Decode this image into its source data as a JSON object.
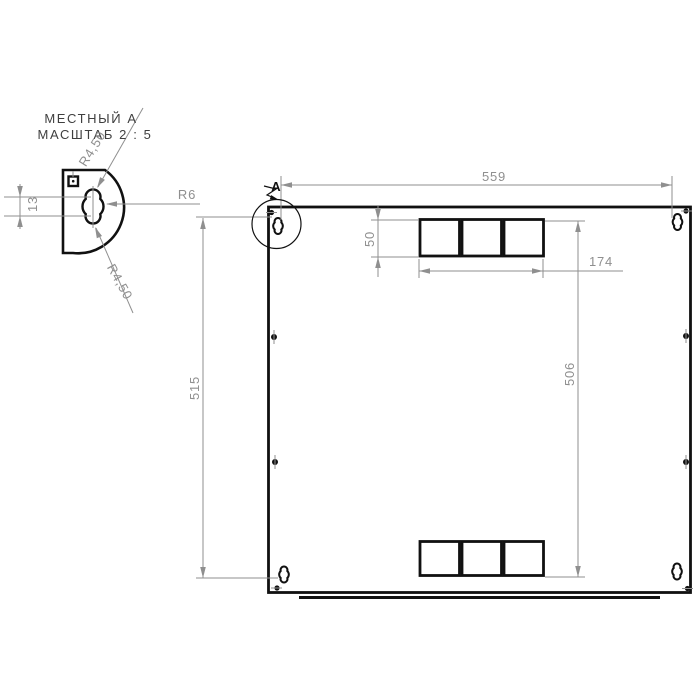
{
  "colors": {
    "outline": "#111111",
    "dimension": "#8f8f8f",
    "background": "#ffffff",
    "title": "#3f3f3f"
  },
  "detail_view": {
    "title": "МЕСТНЫЙ А",
    "scale_note": "МАСШТАБ 2 : 5",
    "dim_lobe_spacing": "13",
    "radius_top_lobe": "R4,50",
    "radius_bottom_lobe": "R4,50",
    "radius_middle": "R6"
  },
  "main_view": {
    "detail_marker": "A",
    "dim_overall_width": "559",
    "dim_overall_height": "515",
    "dim_slot_height": "50",
    "dim_slot_group_width": "174",
    "dim_slot_rows_span": "506"
  }
}
